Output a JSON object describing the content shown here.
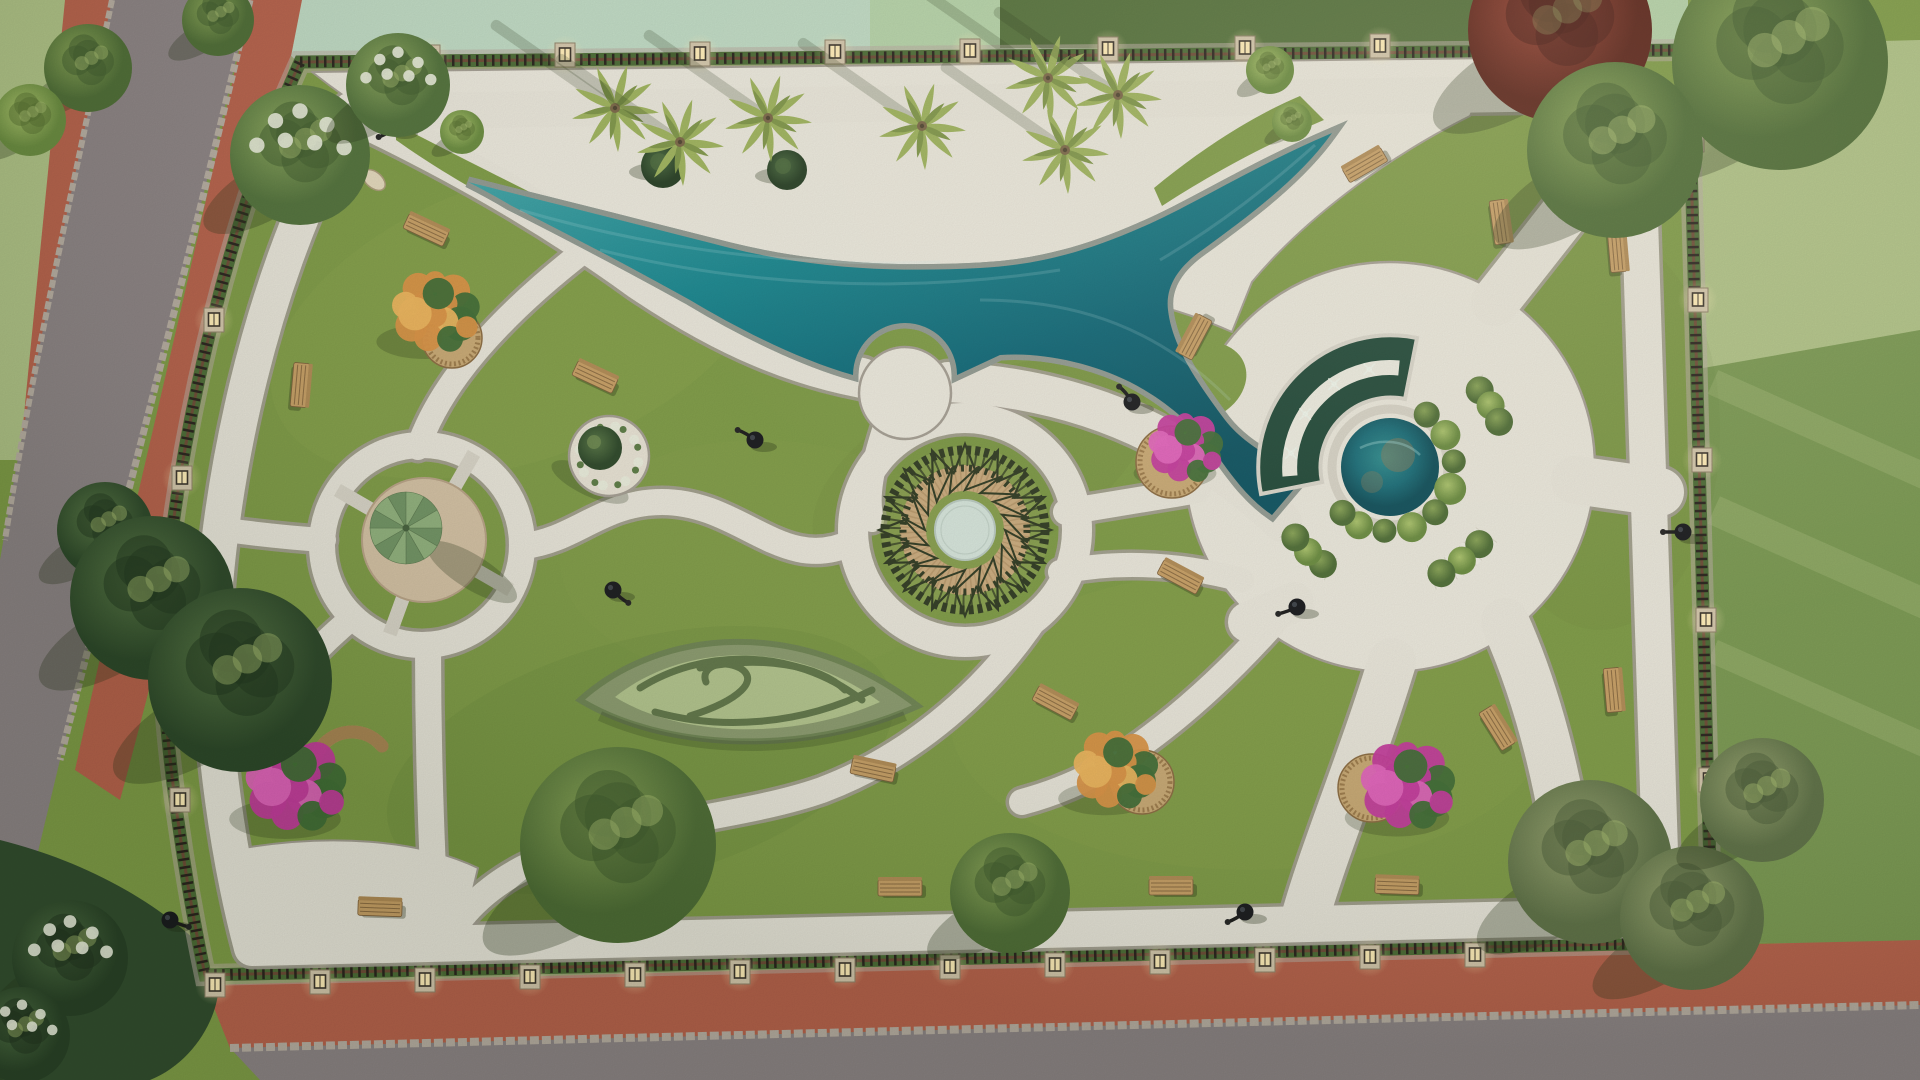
{
  "meta": {
    "description": "Aerial top-down 3D render of a rectangular landscaped park with a curved swimming pool, circular plazas, white walkways, hedge maze, fountains, flower beds, benches and perimeter fence lamps"
  },
  "palette": {
    "parkGrass": "#7d9a45",
    "grassLight": "#a3b95f",
    "grassDark": "#55712f",
    "mintField": "#bed9c3",
    "paleField": "#b2cfa2",
    "hedgeTop": "#53703a",
    "lawnLight": "#aec185",
    "lawnDark": "#789750",
    "lawnStreak": "#cdd89e",
    "road": "#8b8284",
    "cobble": "#b6aca1",
    "sidewalkRed": "#b6604a",
    "sidewalkRedDark": "#9e4f3d",
    "pathWhite": "#e8e5da",
    "pathShade": "#d8d4c8",
    "pathEdge": "#a39d92",
    "deckWhite": "#eae7dc",
    "poolDeep": "#0b6374",
    "poolMid": "#17858e",
    "poolLight": "#45aaab",
    "poolRim": "#d8d5c9",
    "poolCoping": "#8f9890",
    "canalWater": "#1d4636",
    "pondWater": "#156a76",
    "pondTan": "#8d7b55",
    "fenceDark": "#27211b",
    "fenceRail": "#6b4a35",
    "pillarStone": "#d3c6ab",
    "lampGlow": "#ffedb8",
    "lampFrame": "#3a332a",
    "benchWood": "#c69e64",
    "benchSlat": "#8a6a40",
    "benchBack": "#b08a54",
    "lampBlack": "#17181c",
    "umbrellaA": "#8fb07c",
    "umbrellaB": "#6f9263",
    "padTan": "#d4c1a4",
    "mandalaDark": "#2f3a22",
    "mandalaTan": "#c9aa7d",
    "mandalaTanLine": "#a8885c",
    "mandalaCenter": "#d4e3da",
    "magenta": "#c3399c",
    "magentaLight": "#e262bc",
    "leafGreen": "#3f6b35",
    "orange": "#d99143",
    "orangeLight": "#ecb45c",
    "blossomWhite": "#e9ecdc",
    "mazeOuter": "#8a9a6e",
    "mazeInner": "#b2c48d",
    "mazeHedge": "#5f7548",
    "planterWhite": "#edebe1",
    "shrubDark": "#3c5a33",
    "shrubBright": "#7fa348",
    "treeShadow": "rgba(35,50,22,0.30)"
  },
  "scene": {
    "trees": [
      [
        "round-blossom",
        300,
        155,
        70
      ],
      [
        "round-blossom",
        398,
        85,
        52
      ],
      [
        "bush",
        462,
        132,
        22
      ],
      [
        "conifer",
        105,
        530,
        48
      ],
      [
        "conifer",
        152,
        598,
        82
      ],
      [
        "conifer",
        240,
        680,
        92
      ],
      [
        "round",
        618,
        845,
        98
      ],
      [
        "round",
        1010,
        893,
        60
      ],
      [
        "olive",
        1590,
        862,
        82
      ],
      [
        "olive",
        1692,
        918,
        72
      ],
      [
        "olive",
        1762,
        800,
        62
      ],
      [
        "round",
        1780,
        62,
        108
      ],
      [
        "maroon",
        1560,
        30,
        92
      ],
      [
        "round",
        1615,
        150,
        88
      ],
      [
        "bush",
        1292,
        122,
        20
      ],
      [
        "bush",
        1270,
        70,
        24
      ],
      [
        "round",
        88,
        68,
        44
      ],
      [
        "bush",
        30,
        120,
        36
      ],
      [
        "round",
        218,
        20,
        36
      ],
      [
        "blossom-dark",
        70,
        958,
        58
      ],
      [
        "blossom-dark",
        22,
        1035,
        48
      ]
    ],
    "palms": [
      [
        615,
        108
      ],
      [
        680,
        142
      ],
      [
        768,
        118
      ],
      [
        922,
        126
      ],
      [
        1048,
        78
      ],
      [
        1118,
        95
      ],
      [
        1065,
        150
      ]
    ],
    "benches": [
      [
        426,
        230,
        25
      ],
      [
        595,
        377,
        25
      ],
      [
        300,
        385,
        95
      ],
      [
        1195,
        337,
        -62
      ],
      [
        1365,
        165,
        -30
      ],
      [
        1500,
        222,
        82
      ],
      [
        1617,
        250,
        85
      ],
      [
        1180,
        577,
        28
      ],
      [
        1055,
        703,
        28
      ],
      [
        873,
        770,
        12
      ],
      [
        380,
        908,
        2
      ],
      [
        900,
        888,
        0
      ],
      [
        1171,
        887,
        0
      ],
      [
        1613,
        690,
        85
      ],
      [
        1497,
        728,
        58
      ],
      [
        1397,
        886,
        2
      ]
    ],
    "lamps": [
      [
        310,
        147,
        120
      ],
      [
        396,
        127,
        150
      ],
      [
        613,
        590,
        40
      ],
      [
        755,
        440,
        210
      ],
      [
        1132,
        402,
        230
      ],
      [
        1297,
        607,
        160
      ],
      [
        1683,
        532,
        180
      ],
      [
        170,
        920,
        20
      ],
      [
        1004,
        909,
        200
      ],
      [
        1245,
        912,
        150
      ]
    ],
    "pillar_lamps": [
      [
        430,
        57
      ],
      [
        565,
        55
      ],
      [
        700,
        54
      ],
      [
        835,
        52
      ],
      [
        970,
        51
      ],
      [
        1108,
        49
      ],
      [
        1245,
        48
      ],
      [
        1380,
        46
      ],
      [
        1515,
        45
      ],
      [
        1694,
        140
      ],
      [
        1698,
        300
      ],
      [
        1702,
        460
      ],
      [
        1706,
        620
      ],
      [
        1709,
        780
      ],
      [
        1712,
        930
      ],
      [
        215,
        985
      ],
      [
        320,
        982
      ],
      [
        425,
        980
      ],
      [
        530,
        977
      ],
      [
        635,
        975
      ],
      [
        740,
        972
      ],
      [
        845,
        970
      ],
      [
        950,
        967
      ],
      [
        1055,
        965
      ],
      [
        1160,
        962
      ],
      [
        1265,
        960
      ],
      [
        1370,
        957
      ],
      [
        1475,
        955
      ],
      [
        252,
        172
      ],
      [
        214,
        320
      ],
      [
        182,
        478
      ],
      [
        166,
        635
      ],
      [
        180,
        800
      ]
    ],
    "shrubs": [
      [
        663,
        166,
        22
      ],
      [
        787,
        170,
        20
      ]
    ],
    "flower_clusters": [
      {
        "x": 435,
        "y": 312,
        "r": 54,
        "color": "orange",
        "planter": [
          452,
          338,
          30
        ]
      },
      {
        "x": 1115,
        "y": 770,
        "r": 52,
        "color": "orange",
        "planter": [
          1142,
          782,
          32
        ]
      },
      {
        "x": 295,
        "y": 785,
        "r": 62,
        "color": "magenta",
        "planter": null,
        "curved_bench": [
          352,
          768
        ]
      },
      {
        "x": 1185,
        "y": 448,
        "r": 46,
        "color": "magenta",
        "planter": [
          1172,
          462,
          36
        ]
      },
      {
        "x": 1407,
        "y": 786,
        "r": 58,
        "color": "magenta",
        "planter": [
          1372,
          788,
          34
        ]
      }
    ],
    "umbrella": {
      "x": 406,
      "y": 528,
      "r": 36,
      "pad": [
        424,
        540,
        62
      ]
    },
    "topiary": {
      "x": 609,
      "y": 456,
      "r": 40,
      "ball": [
        600,
        448,
        22
      ]
    },
    "mandala": {
      "x": 965,
      "y": 530,
      "star_points": 16
    },
    "pond": {
      "x": 1390,
      "y": 467,
      "rim": 58,
      "water": 49,
      "shrub_ring": [
        [
          -55,
          64,
          13
        ],
        [
          -30,
          64,
          15
        ],
        [
          -5,
          64,
          12
        ],
        [
          20,
          64,
          16
        ],
        [
          45,
          64,
          13
        ],
        [
          70,
          64,
          15
        ],
        [
          95,
          64,
          12
        ],
        [
          118,
          66,
          14
        ],
        [
          136,
          66,
          13
        ]
      ]
    },
    "planters": [
      {
        "a1": -45,
        "a2": -18
      },
      {
        "a1": 35,
        "a2": 70
      },
      {
        "a1": 120,
        "a2": 148
      }
    ],
    "canal_jets": [
      188,
      212,
      236,
      258
    ]
  }
}
